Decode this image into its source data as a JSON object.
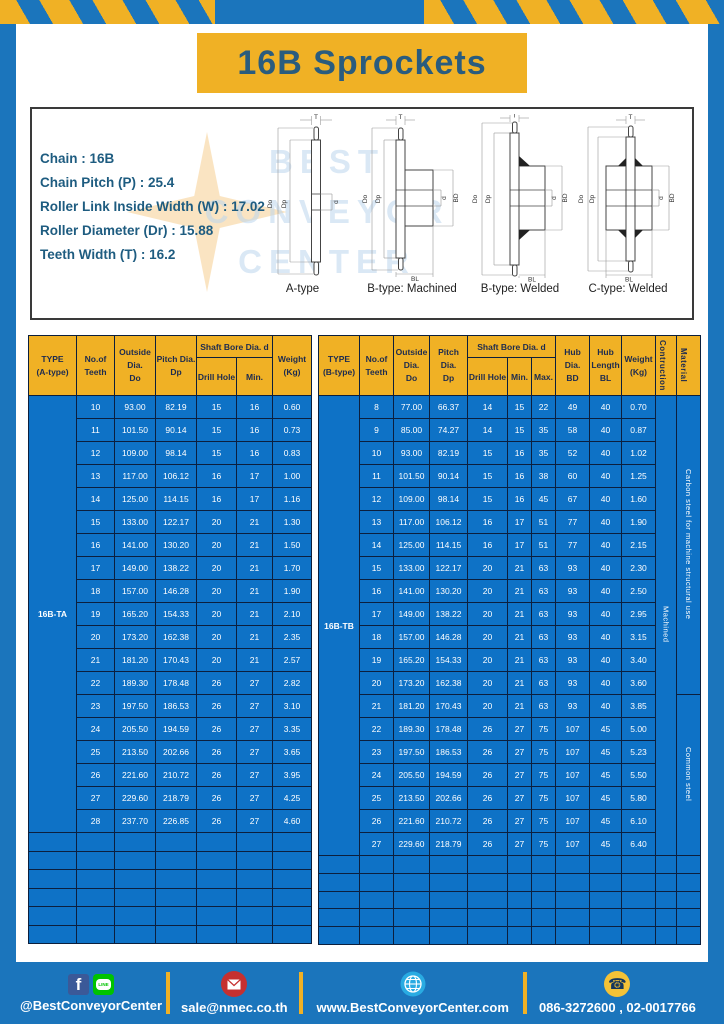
{
  "page": {
    "title": "16B Sprockets"
  },
  "colors": {
    "frame_blue": "#1b75bc",
    "table_blue": "#0e72c6",
    "accent_yellow": "#f0b125",
    "border_navy": "#0c1f3d",
    "teal_text": "#1e5c80"
  },
  "specs": {
    "lines": [
      "Chain  :  16B",
      "Chain Pitch (P)  :  25.4",
      "Roller Link Inside Width (W)  :  17.02",
      "Roller Diameter (Dr)  : 15.88",
      "Teeth Width (T)  :  16.2"
    ],
    "dims": {
      "t": "T",
      "outer": "Do",
      "pitch": "Dp",
      "bore": "d",
      "hub": "BD",
      "hub_len": "BL"
    },
    "diagram_captions": [
      "A-type",
      "B-type: Machined",
      "B-type: Welded",
      "C-type: Welded"
    ],
    "watermark": [
      "BEST",
      "CONVEYOR",
      "CENTER"
    ]
  },
  "table_a": {
    "headers": {
      "type": [
        "TYPE",
        "(A-type)"
      ],
      "teeth": [
        "No.of",
        "Teeth"
      ],
      "outside": [
        "Outside",
        "Dia.",
        "Do"
      ],
      "pitch": [
        "Pitch Dia.",
        "Dp"
      ],
      "shaft_bore": "Shaft Bore Dia. d",
      "drill": "Drill Hole",
      "min": "Min.",
      "weight": [
        "Weight",
        "(Kg)"
      ]
    },
    "type_value": "16B-TA",
    "rows": [
      [
        "10",
        "93.00",
        "82.19",
        "15",
        "16",
        "0.60"
      ],
      [
        "11",
        "101.50",
        "90.14",
        "15",
        "16",
        "0.73"
      ],
      [
        "12",
        "109.00",
        "98.14",
        "15",
        "16",
        "0.83"
      ],
      [
        "13",
        "117.00",
        "106.12",
        "16",
        "17",
        "1.00"
      ],
      [
        "14",
        "125.00",
        "114.15",
        "16",
        "17",
        "1.16"
      ],
      [
        "15",
        "133.00",
        "122.17",
        "20",
        "21",
        "1.30"
      ],
      [
        "16",
        "141.00",
        "130.20",
        "20",
        "21",
        "1.50"
      ],
      [
        "17",
        "149.00",
        "138.22",
        "20",
        "21",
        "1.70"
      ],
      [
        "18",
        "157.00",
        "146.28",
        "20",
        "21",
        "1.90"
      ],
      [
        "19",
        "165.20",
        "154.33",
        "20",
        "21",
        "2.10"
      ],
      [
        "20",
        "173.20",
        "162.38",
        "20",
        "21",
        "2.35"
      ],
      [
        "21",
        "181.20",
        "170.43",
        "20",
        "21",
        "2.57"
      ],
      [
        "22",
        "189.30",
        "178.48",
        "26",
        "27",
        "2.82"
      ],
      [
        "23",
        "197.50",
        "186.53",
        "26",
        "27",
        "3.10"
      ],
      [
        "24",
        "205.50",
        "194.59",
        "26",
        "27",
        "3.35"
      ],
      [
        "25",
        "213.50",
        "202.66",
        "26",
        "27",
        "3.65"
      ],
      [
        "26",
        "221.60",
        "210.72",
        "26",
        "27",
        "3.95"
      ],
      [
        "27",
        "229.60",
        "218.79",
        "26",
        "27",
        "4.25"
      ],
      [
        "28",
        "237.70",
        "226.85",
        "26",
        "27",
        "4.60"
      ]
    ],
    "empty_rows": 6
  },
  "table_b": {
    "headers": {
      "type": [
        "TYPE",
        "(B-type)"
      ],
      "teeth": [
        "No.of",
        "Teeth"
      ],
      "outside": [
        "Outside",
        "Dia.",
        "Do"
      ],
      "pitch": [
        "Pitch Dia.",
        "Dp"
      ],
      "shaft_bore": "Shaft Bore Dia. d",
      "drill": "Drill Hole",
      "min": "Min.",
      "max": "Max.",
      "hub_dia": [
        "Hub Dia.",
        "BD"
      ],
      "hub_len": [
        "Hub",
        "Length",
        "BL"
      ],
      "weight": [
        "Weight",
        "(Kg)"
      ],
      "construction": "Contruction",
      "material": "Material"
    },
    "type_value": "16B-TB",
    "construction_value": "Machined",
    "material_values": [
      "Carbon steel for machine structural use",
      "Common steel"
    ],
    "material_split_rows": [
      13,
      7
    ],
    "rows": [
      [
        "8",
        "77.00",
        "66.37",
        "14",
        "15",
        "22",
        "49",
        "40",
        "0.70"
      ],
      [
        "9",
        "85.00",
        "74.27",
        "14",
        "15",
        "35",
        "58",
        "40",
        "0.87"
      ],
      [
        "10",
        "93.00",
        "82.19",
        "15",
        "16",
        "35",
        "52",
        "40",
        "1.02"
      ],
      [
        "11",
        "101.50",
        "90.14",
        "15",
        "16",
        "38",
        "60",
        "40",
        "1.25"
      ],
      [
        "12",
        "109.00",
        "98.14",
        "15",
        "16",
        "45",
        "67",
        "40",
        "1.60"
      ],
      [
        "13",
        "117.00",
        "106.12",
        "16",
        "17",
        "51",
        "77",
        "40",
        "1.90"
      ],
      [
        "14",
        "125.00",
        "114.15",
        "16",
        "17",
        "51",
        "77",
        "40",
        "2.15"
      ],
      [
        "15",
        "133.00",
        "122.17",
        "20",
        "21",
        "63",
        "93",
        "40",
        "2.30"
      ],
      [
        "16",
        "141.00",
        "130.20",
        "20",
        "21",
        "63",
        "93",
        "40",
        "2.50"
      ],
      [
        "17",
        "149.00",
        "138.22",
        "20",
        "21",
        "63",
        "93",
        "40",
        "2.95"
      ],
      [
        "18",
        "157.00",
        "146.28",
        "20",
        "21",
        "63",
        "93",
        "40",
        "3.15"
      ],
      [
        "19",
        "165.20",
        "154.33",
        "20",
        "21",
        "63",
        "93",
        "40",
        "3.40"
      ],
      [
        "20",
        "173.20",
        "162.38",
        "20",
        "21",
        "63",
        "93",
        "40",
        "3.60"
      ],
      [
        "21",
        "181.20",
        "170.43",
        "20",
        "21",
        "63",
        "93",
        "40",
        "3.85"
      ],
      [
        "22",
        "189.30",
        "178.48",
        "26",
        "27",
        "75",
        "107",
        "45",
        "5.00"
      ],
      [
        "23",
        "197.50",
        "186.53",
        "26",
        "27",
        "75",
        "107",
        "45",
        "5.23"
      ],
      [
        "24",
        "205.50",
        "194.59",
        "26",
        "27",
        "75",
        "107",
        "45",
        "5.50"
      ],
      [
        "25",
        "213.50",
        "202.66",
        "26",
        "27",
        "75",
        "107",
        "45",
        "5.80"
      ],
      [
        "26",
        "221.60",
        "210.72",
        "26",
        "27",
        "75",
        "107",
        "45",
        "6.10"
      ],
      [
        "27",
        "229.60",
        "218.79",
        "26",
        "27",
        "75",
        "107",
        "45",
        "6.40"
      ]
    ],
    "empty_rows": 5
  },
  "footer": {
    "facebook_glyph": "f",
    "line_text": "LINE",
    "phone_glyph": "☎",
    "items": [
      {
        "icon": "facebook-line-icons",
        "label": "@BestConveyorCenter"
      },
      {
        "icon": "email-icon",
        "label": "sale@nmec.co.th"
      },
      {
        "icon": "globe-icon",
        "label": "www.BestConveyorCenter.com"
      },
      {
        "icon": "phone-icon",
        "label": "086-3272600 , 02-0017766"
      }
    ]
  }
}
